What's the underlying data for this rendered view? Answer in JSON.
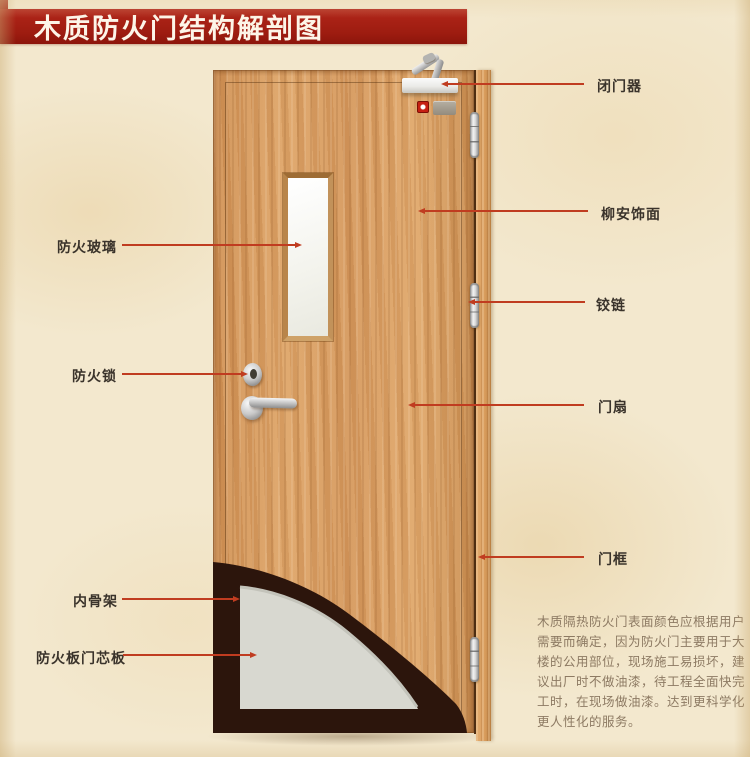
{
  "banner": {
    "title": "木质防火门结构解剖图"
  },
  "labels": {
    "left": [
      {
        "id": "fire-glass",
        "text": "防火玻璃"
      },
      {
        "id": "fire-lock",
        "text": "防火锁"
      },
      {
        "id": "inner-skeleton",
        "text": "内骨架"
      },
      {
        "id": "fire-board-core",
        "text": "防火板门芯板"
      }
    ],
    "right": [
      {
        "id": "door-closer",
        "text": "闭门器"
      },
      {
        "id": "lauan-veneer",
        "text": "柳安饰面"
      },
      {
        "id": "hinge",
        "text": "铰链"
      },
      {
        "id": "door-leaf",
        "text": "门扇"
      },
      {
        "id": "door-frame",
        "text": "门框"
      }
    ]
  },
  "description": {
    "lines": [
      "木质隔热防火门表面颜色应根据用户",
      "需要而确定，因为防火门主要用于大",
      "楼的公用部位，现场施工易损坏，建",
      "议出厂时不做油漆，待工程全面快完",
      "工时，在现场做油漆。达到更科学化",
      "更人性化的服务。"
    ]
  },
  "colors": {
    "banner_red": "#a41e12",
    "banner_text": "#fdf5e8",
    "leader_line": "#c03c20",
    "label_text": "#3a332b",
    "paragraph_text": "#8d7a63",
    "background": "#f3e8ce",
    "door_wood": "#d79a5e",
    "frame_wood": "#dca76b",
    "inner_skeleton_dark": "#2c150c",
    "core_gray": "#d8d8d0",
    "glass_white": "#f8f8f3"
  }
}
